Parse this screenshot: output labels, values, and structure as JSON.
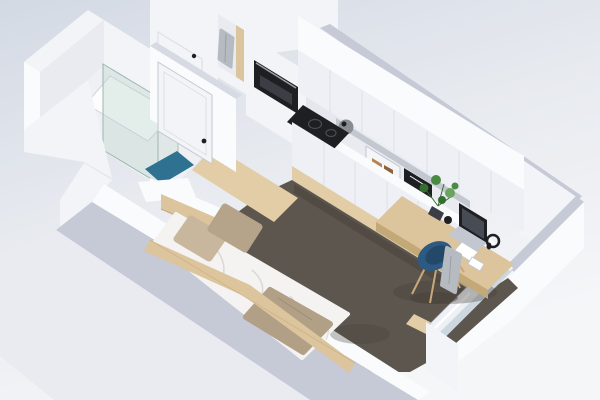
{
  "meta": {
    "subject": "Isometric 3D render of a studio micro-apartment floor plan",
    "projection": "axonometric bird's-eye cutaway (dollhouse view)",
    "background": "light blue-gray gradient",
    "visible_text": "none"
  },
  "scene": {
    "rooms": [
      {
        "id": "bathroom",
        "label": "Bathroom",
        "features": [
          "walk-in shower with glass screen",
          "white shower tray",
          "teal bath mat",
          "white interior door with black handle",
          "white walls"
        ]
      },
      {
        "id": "entry",
        "label": "Entry",
        "features": [
          "entrance door with black handle",
          "open wardrobe niche with wood back and hanging gray robe",
          "tall cabinet column with built-in black oven",
          "light wood floor"
        ]
      },
      {
        "id": "kitchen",
        "label": "Kitchenette",
        "features": [
          "row of white upper cabinets",
          "open shelf with chrome kettle, glass display cabinet, amber jars and black items",
          "black cooktop",
          "white base cabinets",
          "green potted plant"
        ]
      },
      {
        "id": "sleeping-area",
        "label": "Sleeping area",
        "features": [
          "light wood bed frame with side plank",
          "white duvet",
          "two beige pillows",
          "beige throw blanket",
          "wood headboard strip"
        ]
      },
      {
        "id": "work-area",
        "label": "Work corner",
        "features": [
          "built-in light wood desk",
          "laptop",
          "black mug",
          "white notepad",
          "black headphones",
          "twiggy desk plant in dark pot",
          "blue shell chair with wood legs",
          "gray towel draped on chair"
        ]
      },
      {
        "id": "window-wall",
        "label": "Window wall",
        "features": [
          "white panel radiator",
          "white sliding window frame",
          "wood sill"
        ]
      }
    ],
    "floor": {
      "main": "dark taupe carpet",
      "accents": "light oak wood strips",
      "bathroom": "white"
    },
    "walls": "white with gray cut-top edges"
  },
  "colors": {
    "bgTop": "#d3d9e4",
    "bgMid": "#e7eaef",
    "bgBot": "#f5f6f8",
    "wallBright": "#fafbfd",
    "wallLight": "#f3f4f7",
    "wallMid": "#e9ebf1",
    "wallShadow": "#dde1e8",
    "wallCap": "#c5cad6",
    "wallCapLight": "#d6dae3",
    "cabFace": "#eef0f5",
    "steel": "#c2c7d0",
    "floorBath": "#eef0f3",
    "trayWhite": "#fdfdfe",
    "teal": "#2e7191",
    "wood": "#dcc49c",
    "woodDark": "#c3a878",
    "woodFloor": "#e2cda6",
    "carpet": "#5c564e",
    "carpetShade": "#45403a",
    "duvet": "#f4f3f1",
    "duvetShade": "#d8d6d2",
    "pillow": "#c8b79d",
    "pillowDark": "#b5a489",
    "throw": "#b19f86",
    "throwDark": "#96866e",
    "black": "#1d1f22",
    "darkGray": "#3b3e44",
    "screenGray": "#464b54",
    "white": "#ffffff",
    "chairBlue": "#2d5a82",
    "chairBlueDark": "#234868",
    "legWood": "#c8a87a",
    "towelGray": "#b6bbc2",
    "towelFold": "#9aa0a9",
    "green": "#4a8a42",
    "greenDark": "#356f30",
    "green2": "#6aa45f",
    "amber": "#b9854e",
    "amberDark": "#8f6236",
    "kettleChrome": "#898c90",
    "radiator": "#edf0f5",
    "glassWin": "#ccd7e0",
    "glassShower": "#bcd4cd",
    "glassEdge": "#9db6af",
    "ringGray": "#4a4d53",
    "ovenHandle": "#9da1a8"
  }
}
